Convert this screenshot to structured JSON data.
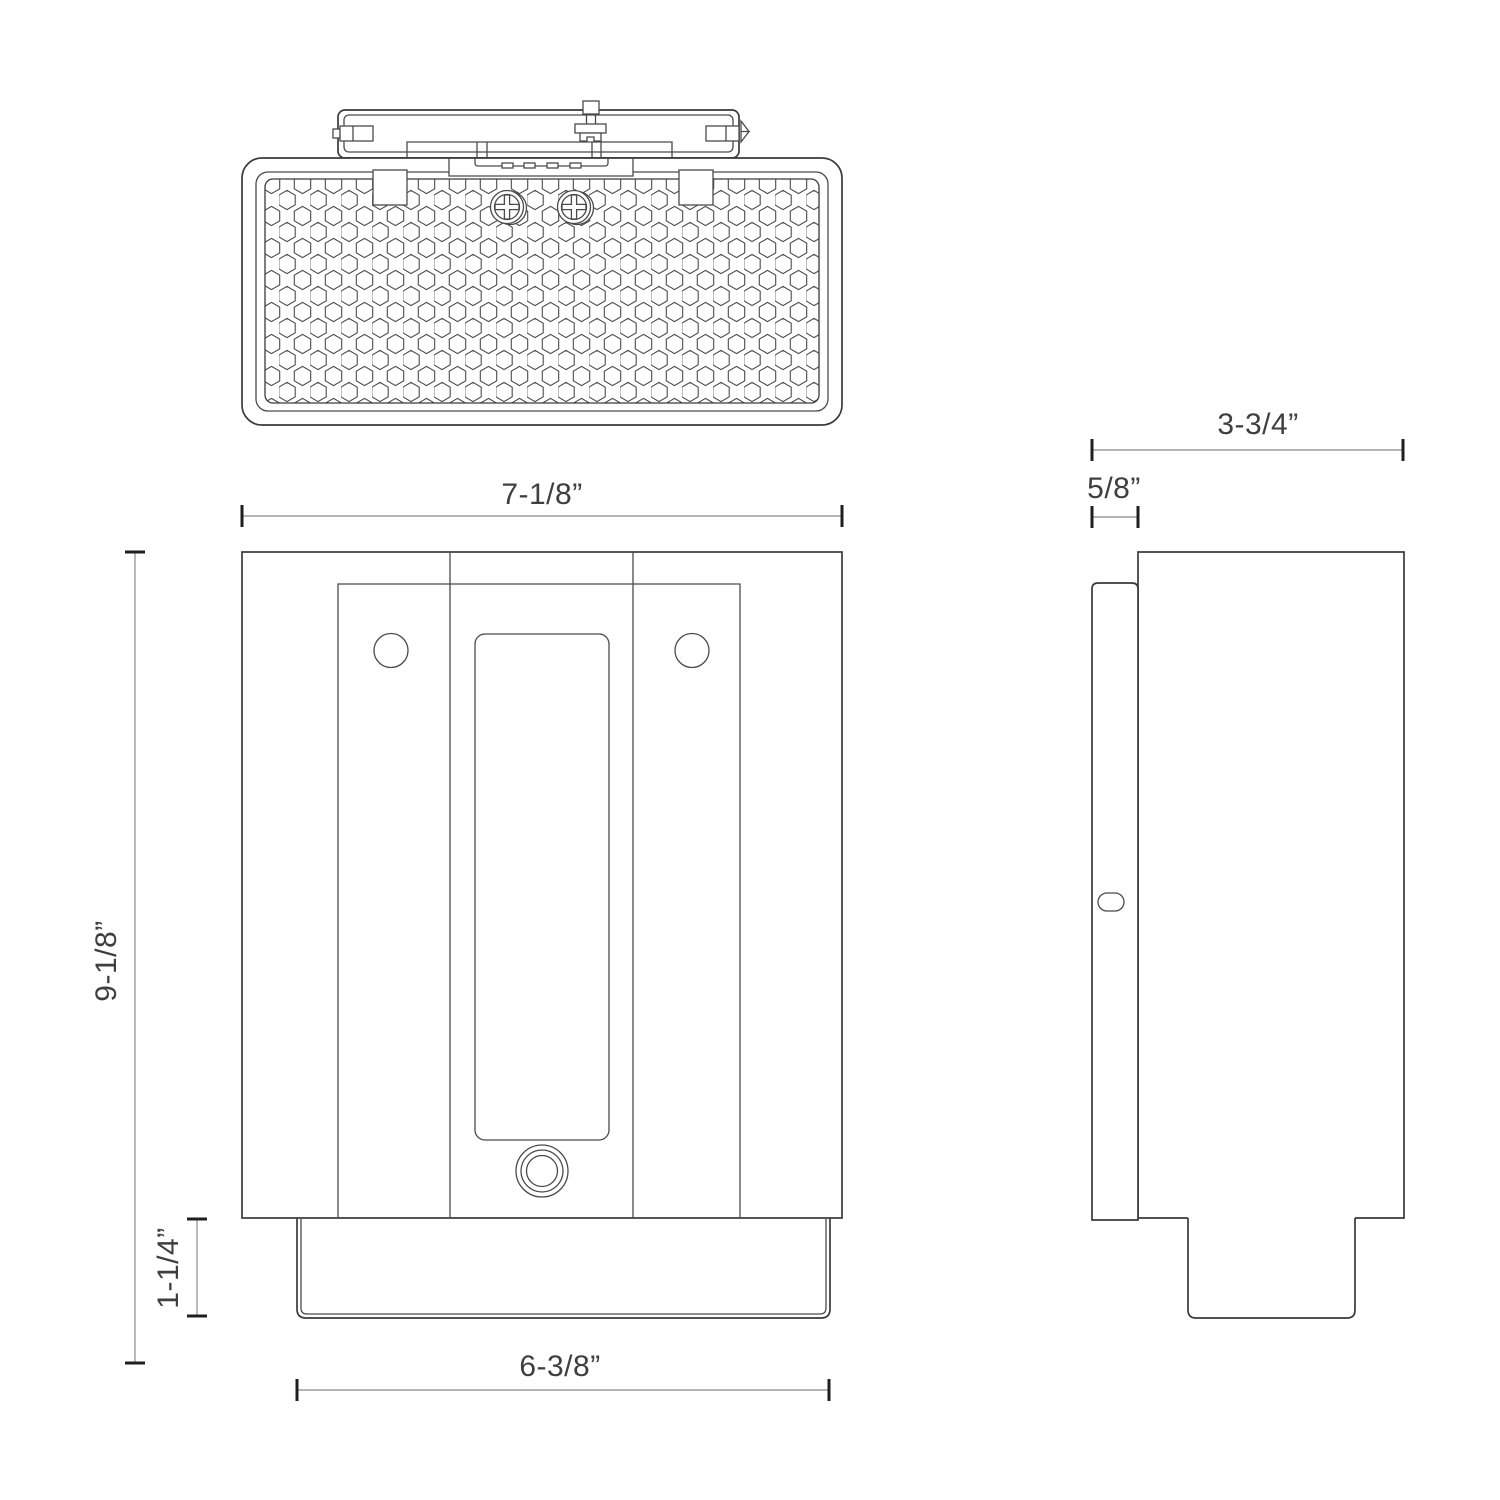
{
  "drawing": {
    "type": "technical-dimension-drawing",
    "views": [
      "top",
      "front",
      "side"
    ],
    "dimensions": {
      "front_width": "7-1/8”",
      "overall_height": "9-1/8”",
      "base_height": "1-1/4”",
      "base_width": "6-3/8”",
      "side_depth": "3-3/4”",
      "mount_plate_depth": "5/8”"
    },
    "style": {
      "line_color": "#3a3a3a",
      "dim_line_color": "#9b9b9b",
      "dim_tick_color": "#1f1f1f",
      "text_color": "#3f3f3f",
      "background": "#ffffff"
    }
  }
}
